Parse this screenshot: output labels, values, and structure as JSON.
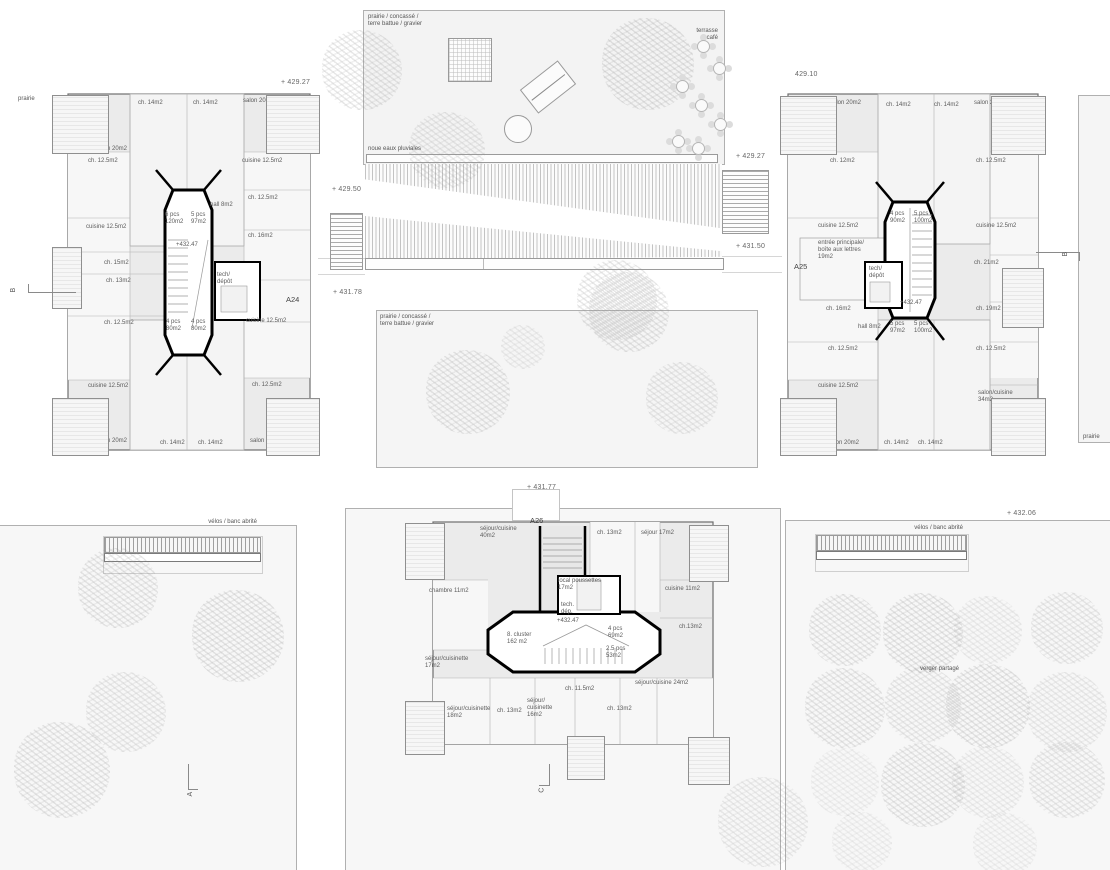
{
  "site": {
    "labels": [
      {
        "t": "prairie",
        "x": 18,
        "y": 96
      },
      {
        "t": "+ 429.27",
        "x": 281,
        "y": 79,
        "cls": "elev"
      },
      {
        "t": "prairie / concassé /\nterre battue / gravier",
        "x": 368,
        "y": 14
      },
      {
        "t": "terrasse\ncafé",
        "x": 660,
        "y": 28,
        "w": 58,
        "cls": "ra"
      },
      {
        "t": "noue eaux pluviales",
        "x": 368,
        "y": 146
      },
      {
        "t": "429.10",
        "x": 795,
        "y": 71,
        "cls": "elev"
      },
      {
        "t": "+ 429.27",
        "x": 736,
        "y": 153,
        "cls": "elev"
      },
      {
        "t": "+ 429.50",
        "x": 332,
        "y": 186,
        "cls": "elev"
      },
      {
        "t": "+ 431.50",
        "x": 736,
        "y": 243,
        "cls": "elev"
      },
      {
        "t": "+ 431.78",
        "x": 333,
        "y": 289,
        "cls": "elev"
      },
      {
        "t": "prairie / concassé /\nterre battue / gravier",
        "x": 380,
        "y": 314
      },
      {
        "t": "A24",
        "x": 286,
        "y": 295,
        "cls": "bid"
      },
      {
        "t": "A25",
        "x": 794,
        "y": 262,
        "cls": "bid"
      },
      {
        "t": "A26",
        "x": 530,
        "y": 516,
        "cls": "bid"
      },
      {
        "t": "+ 431.77",
        "x": 527,
        "y": 484,
        "cls": "elev"
      },
      {
        "t": "vélos / banc abrité",
        "x": 167,
        "y": 519,
        "w": 90,
        "cls": "ra"
      },
      {
        "t": "vélos / banc abrité",
        "x": 873,
        "y": 525,
        "w": 90,
        "cls": "ra"
      },
      {
        "t": "+ 432.06",
        "x": 1007,
        "y": 510,
        "cls": "elev"
      },
      {
        "t": "verger partagé",
        "x": 920,
        "y": 666
      },
      {
        "t": "prairie",
        "x": 1083,
        "y": 434
      }
    ],
    "sections": [
      {
        "t": "B",
        "x": 12,
        "y": 286
      },
      {
        "t": "B",
        "x": 1064,
        "y": 250
      },
      {
        "t": "A",
        "x": 189,
        "y": 790
      },
      {
        "t": "C",
        "x": 540,
        "y": 786
      }
    ]
  },
  "buildings": {
    "a24": {
      "id": "A24",
      "level": "+432.47",
      "rooms": [
        {
          "t": "balcon\n13m2",
          "x": -6,
          "y": 8
        },
        {
          "t": "ch. 14m2",
          "x": 78,
          "y": 10
        },
        {
          "t": "ch. 14m2",
          "x": 133,
          "y": 10
        },
        {
          "t": "salon 20m2",
          "x": 183,
          "y": 8
        },
        {
          "t": "balcon\n13m2",
          "x": 224,
          "y": 8
        },
        {
          "t": "salon 20m2",
          "x": 36,
          "y": 56
        },
        {
          "t": "ch. 12.5m2",
          "x": 28,
          "y": 68
        },
        {
          "t": "cuisine 12.5m2",
          "x": 182,
          "y": 68
        },
        {
          "t": "hall 8m2",
          "x": 150,
          "y": 112
        },
        {
          "t": "ch. 12.5m2",
          "x": 188,
          "y": 105
        },
        {
          "t": "6 pcs\n120m2",
          "x": 105,
          "y": 122
        },
        {
          "t": "5 pcs\n97m2",
          "x": 131,
          "y": 122
        },
        {
          "t": "cuisine 12.5m2",
          "x": 26,
          "y": 134
        },
        {
          "t": "+432.47",
          "x": 116,
          "y": 152
        },
        {
          "t": "ch. 16m2",
          "x": 188,
          "y": 143
        },
        {
          "t": "balcon\n9m2",
          "x": -6,
          "y": 170
        },
        {
          "t": "ch. 15m2",
          "x": 44,
          "y": 170
        },
        {
          "t": "ch. 13m2",
          "x": 46,
          "y": 188
        },
        {
          "t": "tech/\ndépôt",
          "x": 157,
          "y": 182
        },
        {
          "t": "ch. 12.5m2",
          "x": 44,
          "y": 230
        },
        {
          "t": "cuisine 12.5m2",
          "x": 186,
          "y": 228
        },
        {
          "t": "4 pcs\n80m2",
          "x": 106,
          "y": 229
        },
        {
          "t": "4 pcs\n80m2",
          "x": 131,
          "y": 229
        },
        {
          "t": "cuisine 12.5m2",
          "x": 28,
          "y": 293
        },
        {
          "t": "ch. 12.5m2",
          "x": 192,
          "y": 292
        },
        {
          "t": "balcon\n13m2",
          "x": -6,
          "y": 344
        },
        {
          "t": "salon 20m2",
          "x": 36,
          "y": 348
        },
        {
          "t": "ch. 14m2",
          "x": 100,
          "y": 350
        },
        {
          "t": "ch. 14m2",
          "x": 138,
          "y": 350
        },
        {
          "t": "salon 20m2",
          "x": 190,
          "y": 348
        },
        {
          "t": "balcon\n13m2",
          "x": 224,
          "y": 344
        }
      ]
    },
    "a25": {
      "id": "A25",
      "level": "+432.47",
      "rooms": [
        {
          "t": "balcon\n13m2",
          "x": 0,
          "y": 8
        },
        {
          "t": "salon 20m2",
          "x": 48,
          "y": 10
        },
        {
          "t": "ch. 14m2",
          "x": 104,
          "y": 12
        },
        {
          "t": "ch. 14m2",
          "x": 152,
          "y": 12
        },
        {
          "t": "salon 20m2",
          "x": 192,
          "y": 10
        },
        {
          "t": "balcon\n13m2",
          "x": 228,
          "y": 8
        },
        {
          "t": "ch. 12m2",
          "x": 48,
          "y": 68
        },
        {
          "t": "ch. 12.5m2",
          "x": 194,
          "y": 68
        },
        {
          "t": "cuisine 12.5m2",
          "x": 36,
          "y": 133
        },
        {
          "t": "cuisine 12.5m2",
          "x": 194,
          "y": 133
        },
        {
          "t": "4 pcs\n90m2",
          "x": 108,
          "y": 121
        },
        {
          "t": "5 pcs\n100m2",
          "x": 132,
          "y": 121
        },
        {
          "t": "entrée principale/\nboîte aux lettres\n19m2",
          "x": 36,
          "y": 150
        },
        {
          "t": "tech/\ndépôt",
          "x": 87,
          "y": 176
        },
        {
          "t": "ch. 21m2",
          "x": 192,
          "y": 170
        },
        {
          "t": "+432.47",
          "x": 118,
          "y": 210
        },
        {
          "t": "ch. 16m2",
          "x": 44,
          "y": 216
        },
        {
          "t": "ch. 19m2",
          "x": 194,
          "y": 216
        },
        {
          "t": "balcon\n9m2",
          "x": 224,
          "y": 184
        },
        {
          "t": "hall 8m2",
          "x": 76,
          "y": 234
        },
        {
          "t": "5 pcs\n97m2",
          "x": 108,
          "y": 231
        },
        {
          "t": "5 pcs\n100m2",
          "x": 132,
          "y": 231
        },
        {
          "t": "ch. 12.5m2",
          "x": 46,
          "y": 256
        },
        {
          "t": "ch. 12.5m2",
          "x": 194,
          "y": 256
        },
        {
          "t": "cuisine 12.5m2",
          "x": 36,
          "y": 293
        },
        {
          "t": "salon/cuisine\n34m2",
          "x": 196,
          "y": 300
        },
        {
          "t": "balcon\n13m2",
          "x": 2,
          "y": 344
        },
        {
          "t": "salon 20m2",
          "x": 46,
          "y": 350
        },
        {
          "t": "ch. 14m2",
          "x": 102,
          "y": 350
        },
        {
          "t": "ch. 14m2",
          "x": 136,
          "y": 350
        },
        {
          "t": "balcon\n13m2",
          "x": 228,
          "y": 344
        }
      ]
    },
    "a26": {
      "id": "A26",
      "level": "+432.47",
      "rooms": [
        {
          "t": "balcon\n14m2",
          "x": -16,
          "y": 8
        },
        {
          "t": "séjour/cuisine\n40m2",
          "x": 55,
          "y": 8
        },
        {
          "t": "ch. 13m2",
          "x": 172,
          "y": 12
        },
        {
          "t": "séjour 17m2",
          "x": 216,
          "y": 12
        },
        {
          "t": "balcon\n14m2",
          "x": 266,
          "y": 12
        },
        {
          "t": "chambre 11m2",
          "x": 4,
          "y": 70
        },
        {
          "t": "local poussettes\n17m2",
          "x": 133,
          "y": 60
        },
        {
          "t": "tech.\ndép.",
          "x": 136,
          "y": 84
        },
        {
          "t": "cuisine 11m2",
          "x": 240,
          "y": 68
        },
        {
          "t": "ch.13m2",
          "x": 254,
          "y": 106
        },
        {
          "t": "séjour/cuisinette\n17m2",
          "x": 0,
          "y": 138
        },
        {
          "t": "8. cluster\n162 m2",
          "x": 82,
          "y": 114
        },
        {
          "t": "+432.47",
          "x": 132,
          "y": 100
        },
        {
          "t": "4 pcs\n69m2",
          "x": 183,
          "y": 108
        },
        {
          "t": "2.5 pcs\n53m2",
          "x": 181,
          "y": 128
        },
        {
          "t": "séjour/cuisine 24m2",
          "x": 210,
          "y": 162
        },
        {
          "t": "ch. 11.5m2",
          "x": 140,
          "y": 168
        },
        {
          "t": "séjour/\ncuisinette\n16m2",
          "x": 102,
          "y": 180
        },
        {
          "t": "séjour/cuisinette\n18m2",
          "x": 22,
          "y": 188
        },
        {
          "t": "ch. 13m2",
          "x": 72,
          "y": 190
        },
        {
          "t": "ch. 13m2",
          "x": 182,
          "y": 188
        },
        {
          "t": "balcon\n14m2",
          "x": -14,
          "y": 222
        },
        {
          "t": "balcon\n8m2",
          "x": 146,
          "y": 244
        },
        {
          "t": "balcon\n14m2",
          "x": 265,
          "y": 226
        }
      ]
    }
  },
  "landscape": {
    "trees": [
      {
        "x": 362,
        "y": 70,
        "r": 40,
        "o": 0.5
      },
      {
        "x": 648,
        "y": 64,
        "r": 46,
        "o": 0.55
      },
      {
        "x": 447,
        "y": 150,
        "r": 38,
        "o": 0.45
      },
      {
        "x": 617,
        "y": 300,
        "r": 40,
        "o": 0.5
      },
      {
        "x": 468,
        "y": 392,
        "r": 42,
        "o": 0.5
      },
      {
        "x": 523,
        "y": 347,
        "r": 22,
        "o": 0.35
      },
      {
        "x": 629,
        "y": 312,
        "r": 40,
        "o": 0.5
      },
      {
        "x": 682,
        "y": 398,
        "r": 36,
        "o": 0.45
      },
      {
        "x": 118,
        "y": 588,
        "r": 40,
        "o": 0.5
      },
      {
        "x": 238,
        "y": 636,
        "r": 46,
        "o": 0.55
      },
      {
        "x": 126,
        "y": 712,
        "r": 40,
        "o": 0.45
      },
      {
        "x": 62,
        "y": 770,
        "r": 48,
        "o": 0.5
      },
      {
        "x": 763,
        "y": 822,
        "r": 45,
        "o": 0.4
      },
      {
        "x": 845,
        "y": 630,
        "r": 36,
        "o": 0.5
      },
      {
        "x": 923,
        "y": 633,
        "r": 40,
        "o": 0.55
      },
      {
        "x": 988,
        "y": 630,
        "r": 34,
        "o": 0.35
      },
      {
        "x": 1067,
        "y": 628,
        "r": 36,
        "o": 0.45
      },
      {
        "x": 845,
        "y": 708,
        "r": 40,
        "o": 0.5
      },
      {
        "x": 923,
        "y": 705,
        "r": 38,
        "o": 0.45
      },
      {
        "x": 988,
        "y": 706,
        "r": 42,
        "o": 0.55
      },
      {
        "x": 1067,
        "y": 712,
        "r": 40,
        "o": 0.4
      },
      {
        "x": 845,
        "y": 782,
        "r": 34,
        "o": 0.3
      },
      {
        "x": 923,
        "y": 785,
        "r": 42,
        "o": 0.5
      },
      {
        "x": 988,
        "y": 782,
        "r": 36,
        "o": 0.35
      },
      {
        "x": 1067,
        "y": 780,
        "r": 38,
        "o": 0.45
      },
      {
        "x": 862,
        "y": 842,
        "r": 30,
        "o": 0.3
      },
      {
        "x": 1005,
        "y": 845,
        "r": 32,
        "o": 0.3
      }
    ],
    "cafe_tables": [
      {
        "x": 697,
        "y": 40
      },
      {
        "x": 713,
        "y": 62
      },
      {
        "x": 676,
        "y": 80
      },
      {
        "x": 695,
        "y": 99
      },
      {
        "x": 714,
        "y": 118
      },
      {
        "x": 672,
        "y": 135
      },
      {
        "x": 692,
        "y": 142
      }
    ]
  },
  "colors": {
    "paper": "#ffffff",
    "building_fill": "#ebebeb",
    "wall": "#6e6e6e",
    "core_wall": "#000000",
    "text": "#555555",
    "tree": "#c9c9c9"
  }
}
